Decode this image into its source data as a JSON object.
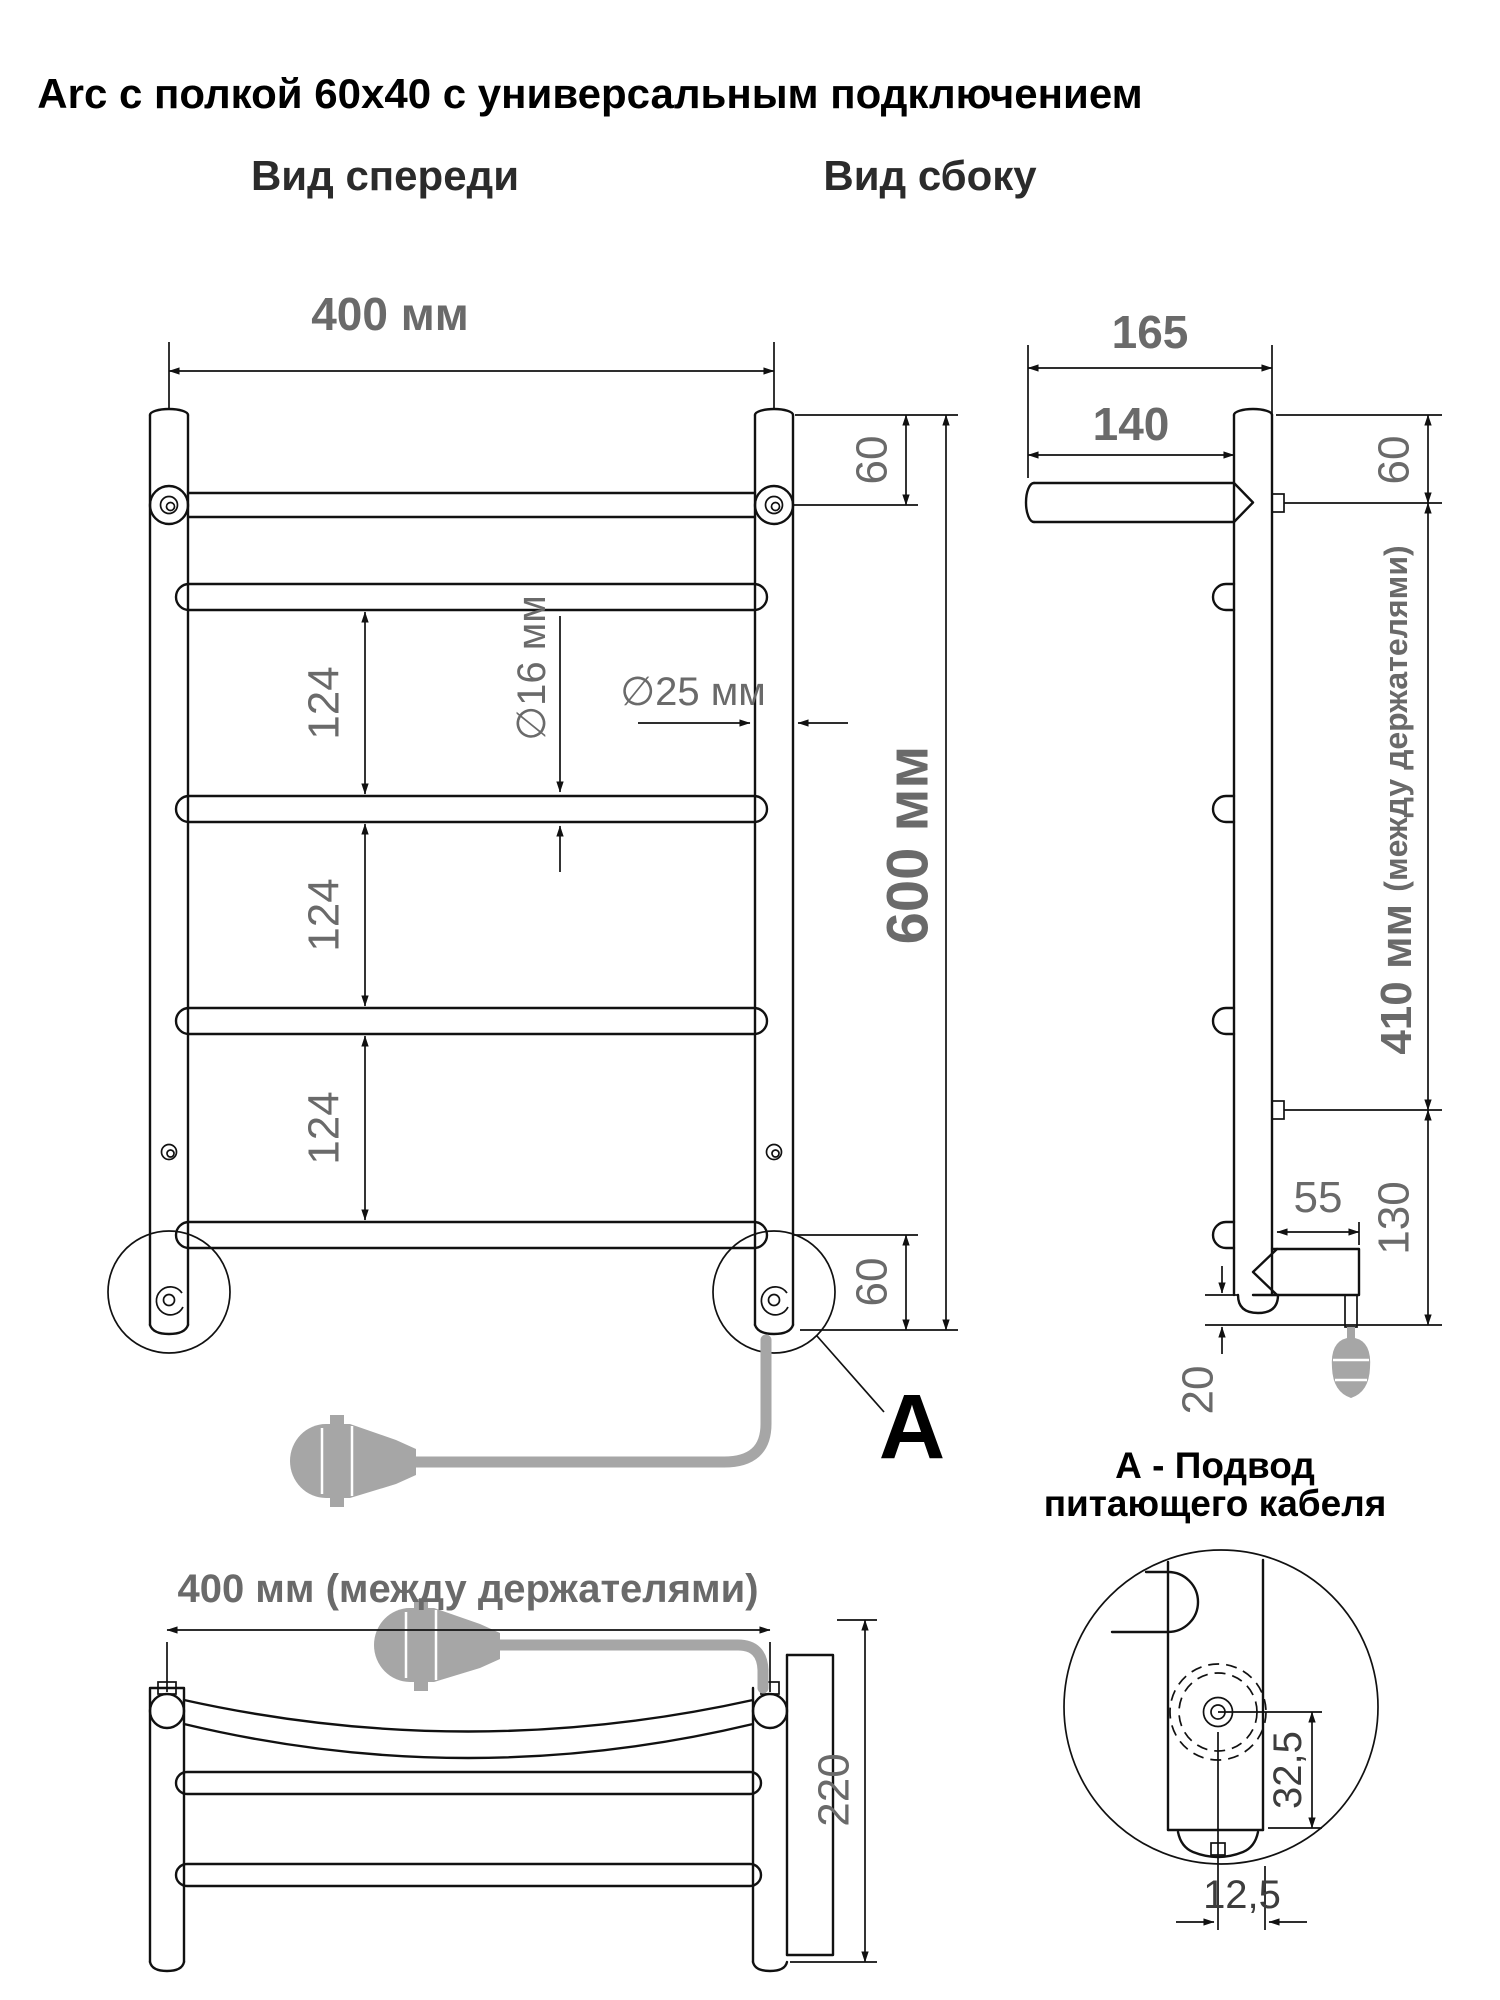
{
  "title": "Arc с полкой 60x40 с универсальным подключением",
  "colors": {
    "line": "#111111",
    "dim_text": "#6a6a6a",
    "cable": "#a6a6a6",
    "background": "#ffffff"
  },
  "front_view": {
    "label": "Вид спереди",
    "width_dim": "400 мм",
    "height_dim": "600 мм",
    "top_offset_dim": "60",
    "bottom_offset_dim": "60",
    "spacing_dims": [
      "124",
      "124",
      "124"
    ],
    "tube_diameter_dim": "∅16 мм",
    "post_diameter_dim": "∅25 мм",
    "callout_label": "A"
  },
  "side_view": {
    "label": "Вид сбоку",
    "depth_dim": "165",
    "shelf_dim": "140",
    "top_offset_dim": "60",
    "holders_dim": "410 мм ",
    "holders_dim_note": "(между держателями)",
    "bottom_arm_dim": "55",
    "bottom_offset_dim": "130",
    "cap_dim": "20"
  },
  "bottom_view": {
    "width_dim": "400 мм (между держателями)",
    "depth_dim": "220"
  },
  "detail_view": {
    "caption_line1": "А - Подвод",
    "caption_line2": "питающего кабеля",
    "center_dim": "32,5",
    "edge_dim": "12,5"
  }
}
